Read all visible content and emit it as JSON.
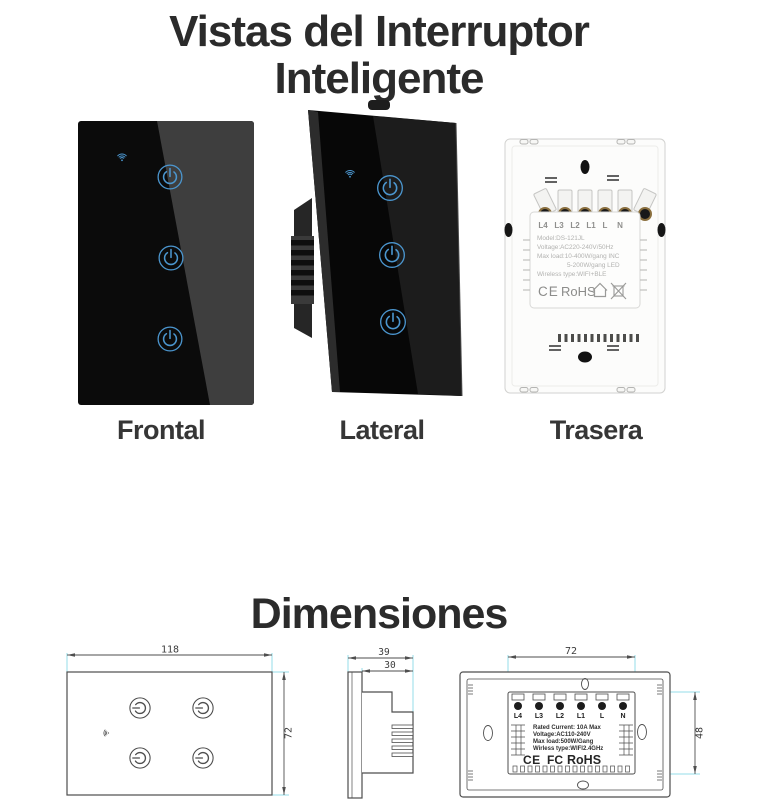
{
  "header": {
    "title_line1": "Vistas del Interruptor",
    "title_line2": "Inteligente"
  },
  "views": {
    "frontal": {
      "label": "Frontal"
    },
    "lateral": {
      "label": "Lateral"
    },
    "trasera": {
      "label": "Trasera",
      "terminals": [
        "L4",
        "L3",
        "L2",
        "L1",
        "L",
        "N"
      ],
      "specs": {
        "model": "Model:DS-121JL",
        "voltage": "Voltage:AC220-240V/50Hz",
        "max_load_1": "Max load:10-400W/gang  INC",
        "max_load_2": "5-200W/gang  LED",
        "wireless": "Wireless type:WIFI+BLE"
      },
      "cert_ce": "CE",
      "cert_rohs": "RoHS"
    }
  },
  "dimensions_section": {
    "title": "Dimensiones",
    "front_view": {
      "width_mm": "118",
      "height_mm": "72"
    },
    "side_view": {
      "total_depth_mm": "39",
      "body_depth_mm": "30"
    },
    "back_view": {
      "width_mm": "72",
      "height_mm": "48",
      "terminals": [
        "L4",
        "L3",
        "L2",
        "L1",
        "L",
        "N"
      ],
      "specs": {
        "rated": "Rated Current: 10A Max",
        "voltage": "Voltage:AC110-240V",
        "max_load": "Max load:500W/Gang",
        "wireless": "Wirless type:WIFI2.4GHz"
      },
      "cert_ce": "CE",
      "cert_fc": "FC",
      "cert_rohs": "RoHS"
    }
  },
  "colors": {
    "accent_blue": "#4b96cf",
    "glass_black": "#0b0b0b",
    "dim_line": "#4e4e4e",
    "extension_cyan": "#96dde8"
  }
}
